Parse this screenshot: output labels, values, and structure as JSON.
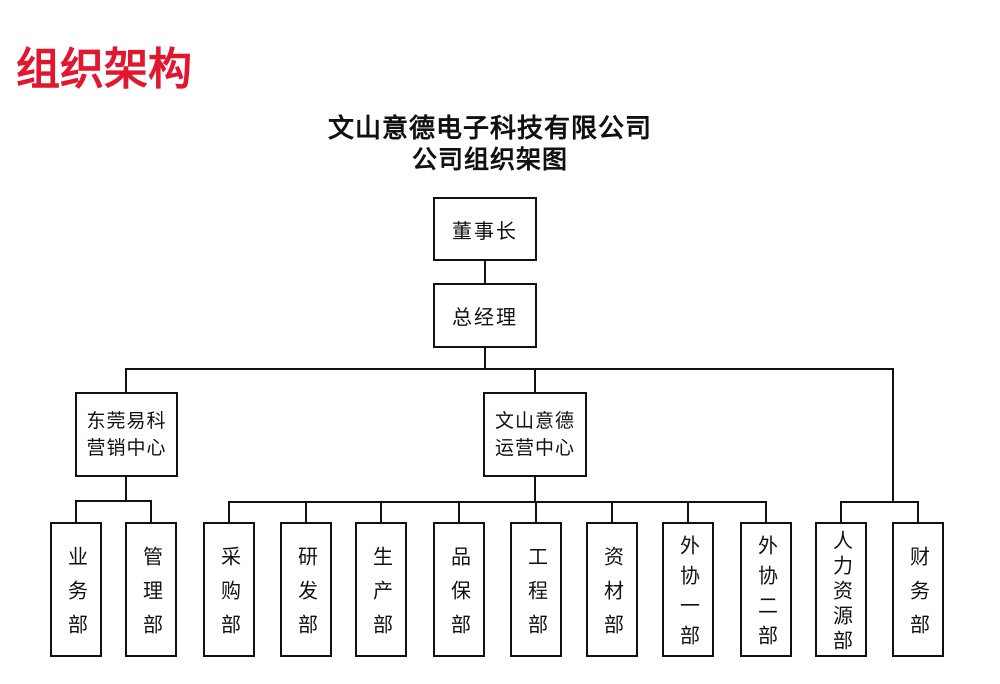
{
  "page": {
    "heading": "组织架构",
    "heading_color": "#e2162f",
    "line_color": "#111111",
    "background_color": "#ffffff"
  },
  "chart": {
    "title_line1": "文山意德电子科技有限公司",
    "title_line2": "公司组织架图"
  },
  "org": {
    "chairman": {
      "label": "董事长"
    },
    "general_manager": {
      "label": "总经理"
    },
    "centers": [
      {
        "line1": "东莞易科",
        "line2": "营销中心",
        "departments": [
          {
            "label": "业务部"
          },
          {
            "label": "管理部"
          }
        ]
      },
      {
        "line1": "文山意德",
        "line2": "运营中心",
        "departments": [
          {
            "label": "采购部"
          },
          {
            "label": "研发部"
          },
          {
            "label": "生产部"
          },
          {
            "label": "品保部"
          },
          {
            "label": "工程部"
          },
          {
            "label": "资材部"
          },
          {
            "label": "外协一部"
          },
          {
            "label": "外协二部"
          }
        ]
      }
    ],
    "direct_departments": [
      {
        "label": "人力资源部"
      },
      {
        "label": "财务部"
      }
    ]
  }
}
